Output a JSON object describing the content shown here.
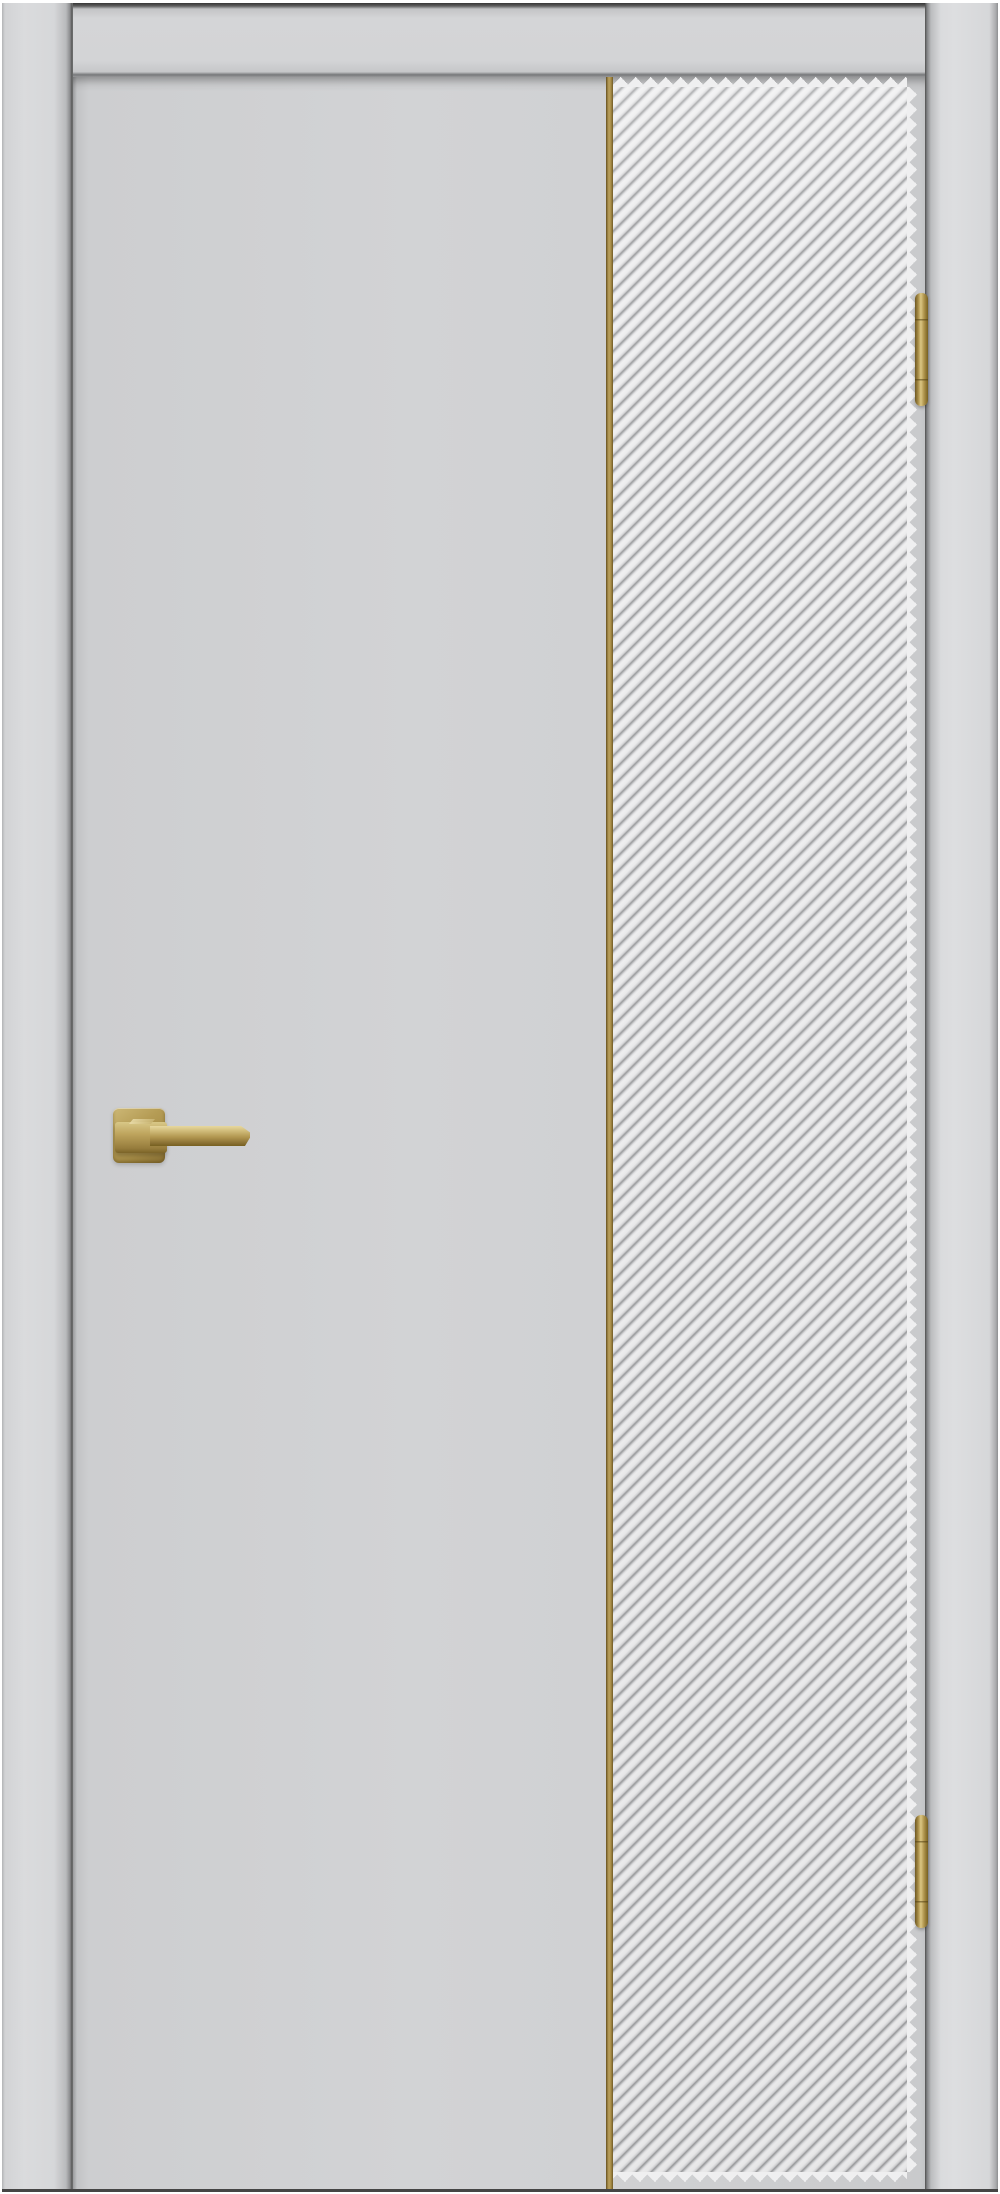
{
  "page": {
    "kind": "product-photo",
    "subject": "Interior door, light grey enamel finish, with full-height diagonal fluted decorative panel, vertical brass inlay strip, brass lever handle on square rosette, and two brass hinges",
    "background_color": "#ffffff",
    "visible_text": ""
  },
  "palette": {
    "background": "#ffffff",
    "frame_grey": "#d5d6d8",
    "door_grey": "#cdced0",
    "panel_ridge": "#efeff0",
    "panel_groove": "#98999b",
    "brass": "#a98e49",
    "brass_highlight": "#e2d49c",
    "brass_shadow": "#77601f",
    "seam_dark": "#5a5a5a"
  },
  "elements": {
    "frame_left_jamb": {
      "label": "Door frame - left jamb"
    },
    "frame_header": {
      "label": "Door frame - top header rail"
    },
    "frame_right_jamb": {
      "label": "Door frame - right jamb"
    },
    "door_leaf": {
      "label": "Door leaf, flat light-grey face"
    },
    "inlay_strip": {
      "label": "Vertical brass inlay strip between flat face and fluted panel"
    },
    "fluted_panel": {
      "label": "Full-height fluted panel with 45-degree diagonal flutes",
      "stripe_angle_deg": 45,
      "stripe_direction": "bottom-left to top-right"
    },
    "fluted_panel_teeth_top": {
      "label": "Flute ends at panel top edge"
    },
    "fluted_panel_teeth_bottom": {
      "label": "Flute ends at panel bottom edge"
    },
    "fluted_panel_teeth_right": {
      "label": "Flute ends at panel right edge"
    },
    "handle_rosette": {
      "label": "Square brass handle rosette",
      "side": "left"
    },
    "handle_lever": {
      "label": "Brass lever handle bar pointing right"
    },
    "hinge_top": {
      "label": "Top brass hinge on right door edge",
      "side": "right"
    },
    "hinge_bottom": {
      "label": "Bottom brass hinge on right door edge",
      "side": "right"
    },
    "bottom_edge": {
      "label": "Frame bottom edge shadow line"
    }
  }
}
